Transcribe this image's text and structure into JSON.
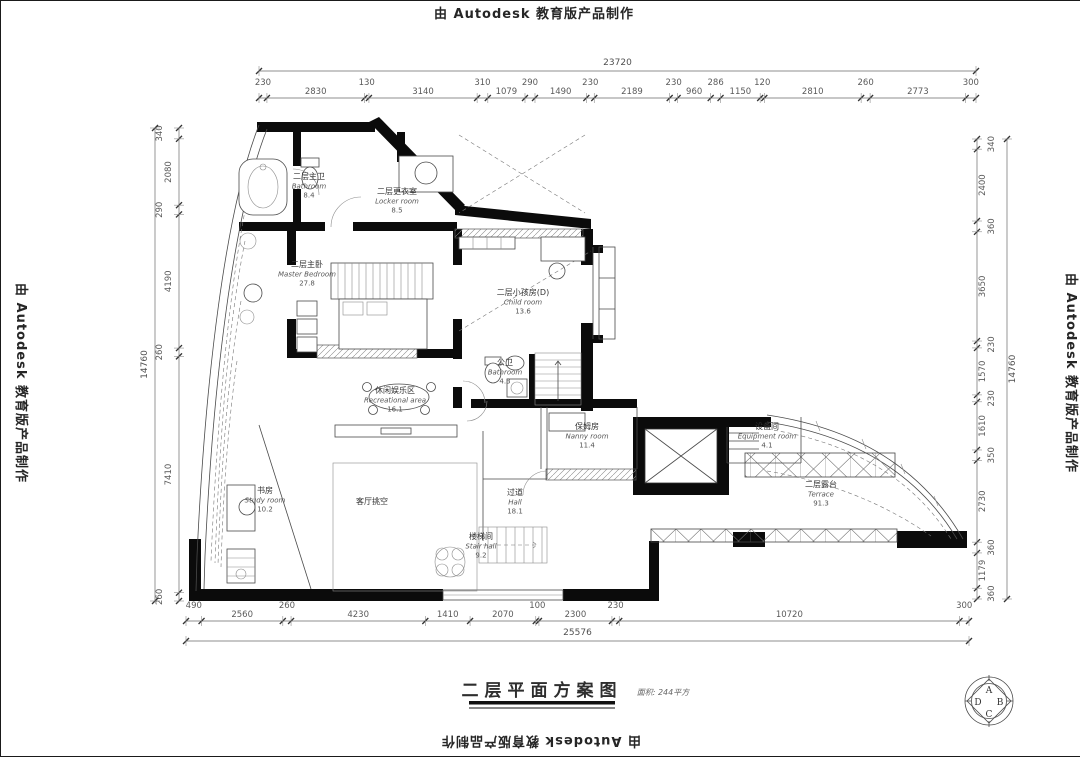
{
  "watermarks": {
    "top": "由 Autodesk 教育版产品制作",
    "bottom": "由 Autodesk 教育版产品制作",
    "left": "由 Autodesk 教育版产品制作",
    "right": "由 Autodesk 教育版产品制作"
  },
  "title": {
    "text": "二层平面方案图",
    "note": "面积: 244平方"
  },
  "logo": {
    "letters": [
      "A",
      "D",
      "B",
      "C"
    ]
  },
  "dims": {
    "top": {
      "overall": "23720",
      "values": [
        "230",
        "2830",
        "130",
        "3140",
        "310",
        "1079",
        "290",
        "1490",
        "230",
        "2189",
        "230",
        "960",
        "286",
        "1150",
        "120",
        "2810",
        "260",
        "2773",
        "300"
      ]
    },
    "bottom": {
      "overall": "25576",
      "values": [
        "490",
        "2560",
        "260",
        "4230",
        "1410",
        "2070",
        "100",
        "2300",
        "230",
        "10720",
        "300"
      ]
    },
    "left": {
      "overall": "14760",
      "values": [
        "340",
        "2080",
        "290",
        "4190",
        "260",
        "7410",
        "260"
      ]
    },
    "right": {
      "overall": "14760",
      "values": [
        "340",
        "2400",
        "360",
        "3650",
        "230",
        "1570",
        "230",
        "1610",
        "350",
        "2730",
        "360",
        "1179",
        "360"
      ]
    }
  },
  "rooms": [
    {
      "id": "master-bathroom",
      "zh": "二层主卫",
      "en": "Bathroom",
      "area": "8.4"
    },
    {
      "id": "locker-room",
      "zh": "二层更衣室",
      "en": "Locker room",
      "area": "8.5"
    },
    {
      "id": "master-bedroom",
      "zh": "二层主卧",
      "en": "Master Bedroom",
      "area": "27.8"
    },
    {
      "id": "child-room-d",
      "zh": "二层小孩房(D)",
      "en": "Child room",
      "area": "13.6"
    },
    {
      "id": "public-bathroom",
      "zh": "公卫",
      "en": "Bathroom",
      "area": "4.3"
    },
    {
      "id": "recreation-area",
      "zh": "休闲娱乐区",
      "en": "Recreational area",
      "area": "16.1"
    },
    {
      "id": "study-room",
      "zh": "书房",
      "en": "Study room",
      "area": "10.2"
    },
    {
      "id": "living-void",
      "zh": "客厅挑空",
      "en": "",
      "area": ""
    },
    {
      "id": "hall",
      "zh": "过道",
      "en": "Hall",
      "area": "18.1"
    },
    {
      "id": "stair-hall",
      "zh": "楼梯间",
      "en": "Stair hall",
      "area": "9.2"
    },
    {
      "id": "nanny-room",
      "zh": "保姆房",
      "en": "Nanny room",
      "area": "11.4"
    },
    {
      "id": "equipment-room",
      "zh": "设备间",
      "en": "Equipment room",
      "area": "4.1"
    },
    {
      "id": "terrace",
      "zh": "二层露台",
      "en": "Terrace",
      "area": "91.3"
    }
  ],
  "colors": {
    "wall": "#0b0b0b",
    "line": "#4a4a4a",
    "dim_text": "#5a5a5a",
    "background": "#ffffff"
  }
}
